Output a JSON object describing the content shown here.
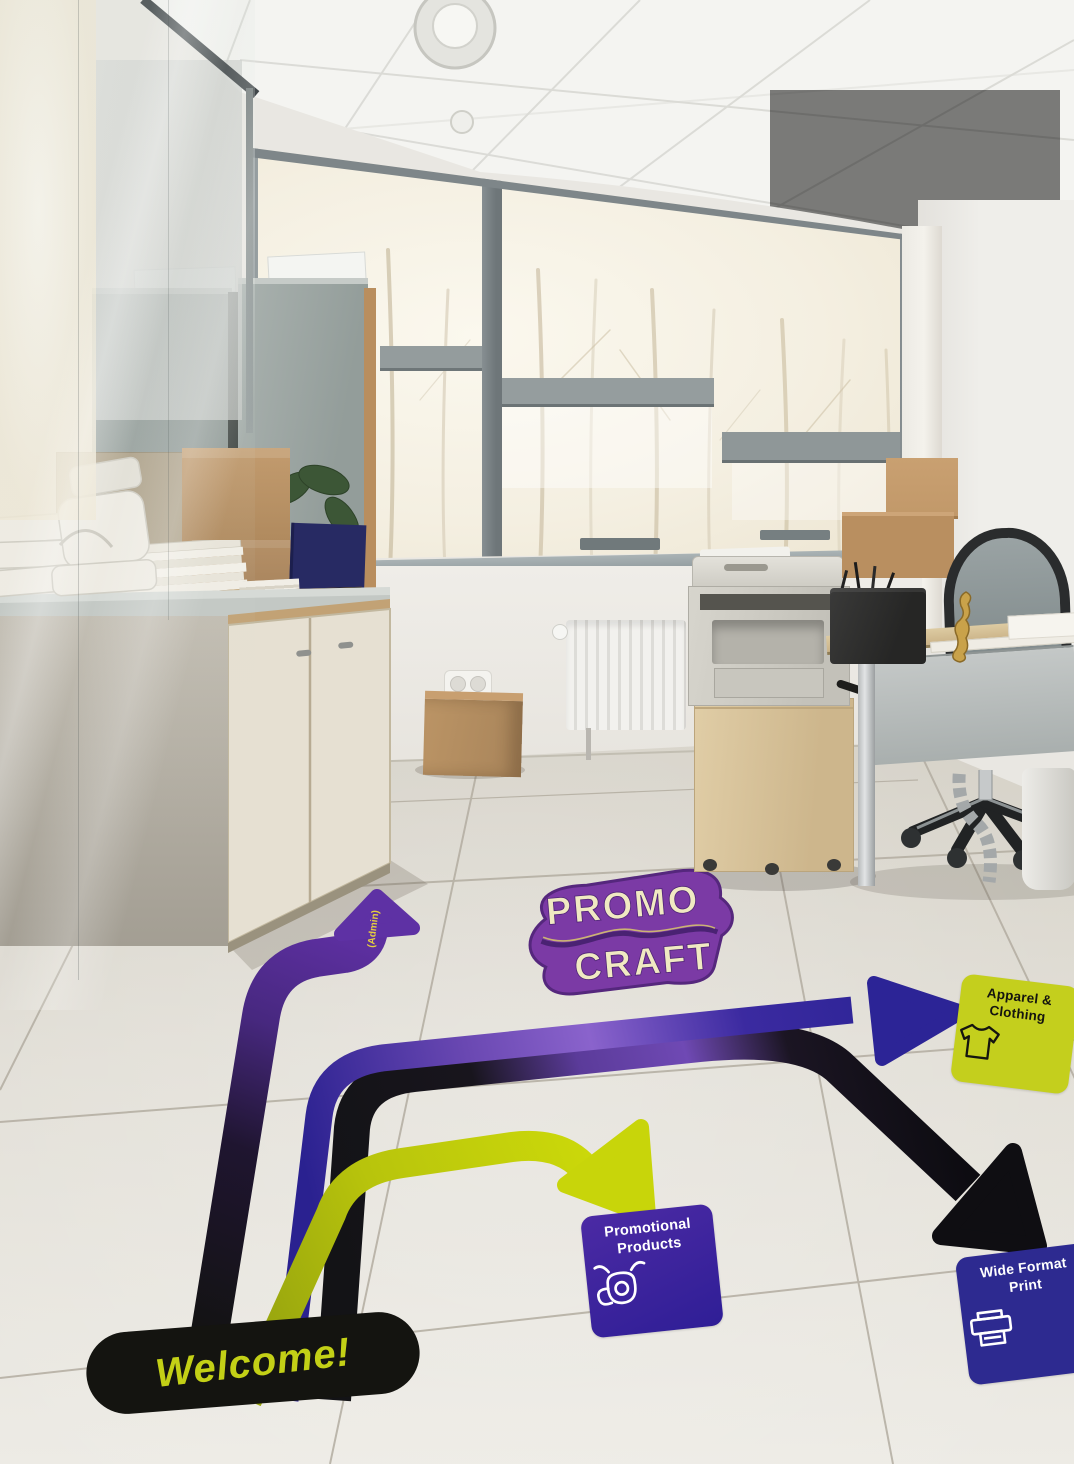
{
  "scene": {
    "kind": "office-interior-photo",
    "description": "Bright office with glass partition, windows onto winter birch trees, printer, desks, and wayfinding vinyl floor decals"
  },
  "floor_decals": {
    "welcome": "Welcome!",
    "logo": {
      "line1": "PROMO",
      "line2": "CRAFT"
    },
    "admin_tag": "(Admin)",
    "destinations": [
      {
        "id": "apparel-clothing",
        "line1": "Apparel &",
        "line2": "Clothing",
        "icon": "tshirt-icon",
        "card_color": "#c4cf1d",
        "text_color": "#15150f",
        "route_color": "#2c2496",
        "arrow_direction": "right"
      },
      {
        "id": "promotional-products",
        "line1": "Promotional",
        "line2": "Products",
        "icon": "mug-icon",
        "card_color": "#3b239c",
        "text_color": "#ffffff",
        "route_color": "#c8d50a",
        "arrow_direction": "down-right"
      },
      {
        "id": "wide-format-print",
        "line1": "Wide Format",
        "line2": "Print",
        "icon": "printer-icon",
        "card_color": "#2d2a90",
        "text_color": "#ffffff",
        "route_color": "#141414",
        "arrow_direction": "down-right"
      }
    ],
    "colors": {
      "purple_route": "#5c2f9f",
      "black_route": "#141414",
      "yellow_route": "#c8d50a",
      "blue_route": "#2c2496",
      "logo_purple": "#7b3aa5",
      "logo_cream": "#f1ebc4",
      "welcome_text": "#c3d016",
      "pill_black": "#141410"
    }
  }
}
